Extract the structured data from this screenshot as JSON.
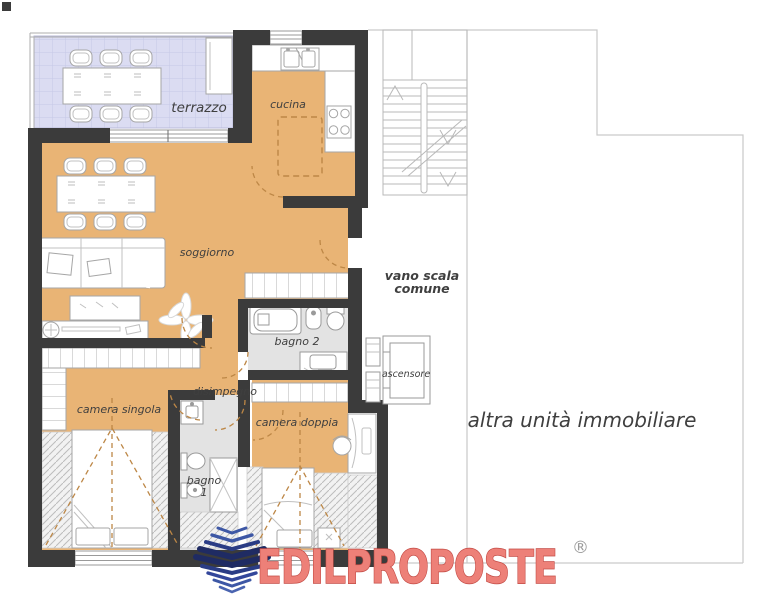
{
  "labels": {
    "terrazzo": "terrazzo",
    "cucina": "cucina",
    "soggiorno": "soggiorno",
    "vano_scala_line1": "vano scala",
    "vano_scala_line2": "comune",
    "bagno2": "bagno 2",
    "ascensore": "ascensore",
    "disimpegno": "disimpegno",
    "camera_singola": "camera singola",
    "camera_doppia": "camera doppia",
    "bagno1_line1": "bagno",
    "bagno1_line2": "1",
    "altra_unita": "altra unità immobiliare"
  },
  "logo": {
    "brand": "EDILPROPOSTE",
    "registered_mark": "®"
  },
  "colors": {
    "floor_orange": "#e9b475",
    "terrace_lavender": "#dbdcf2",
    "bath_grey": "#e3e3e3",
    "wall_dark": "#3b3b3b",
    "dash_accent": "#bd8746",
    "outline_grey": "#a6a6a6",
    "boundary_grey": "#c9c9c9",
    "label_grey": "#3f3f3f",
    "logo_red_fill": "#ed8078",
    "logo_red_stroke": "#c34b45",
    "logo_blue_dark": "#1f2b63",
    "logo_blue": "#3d57a5"
  }
}
